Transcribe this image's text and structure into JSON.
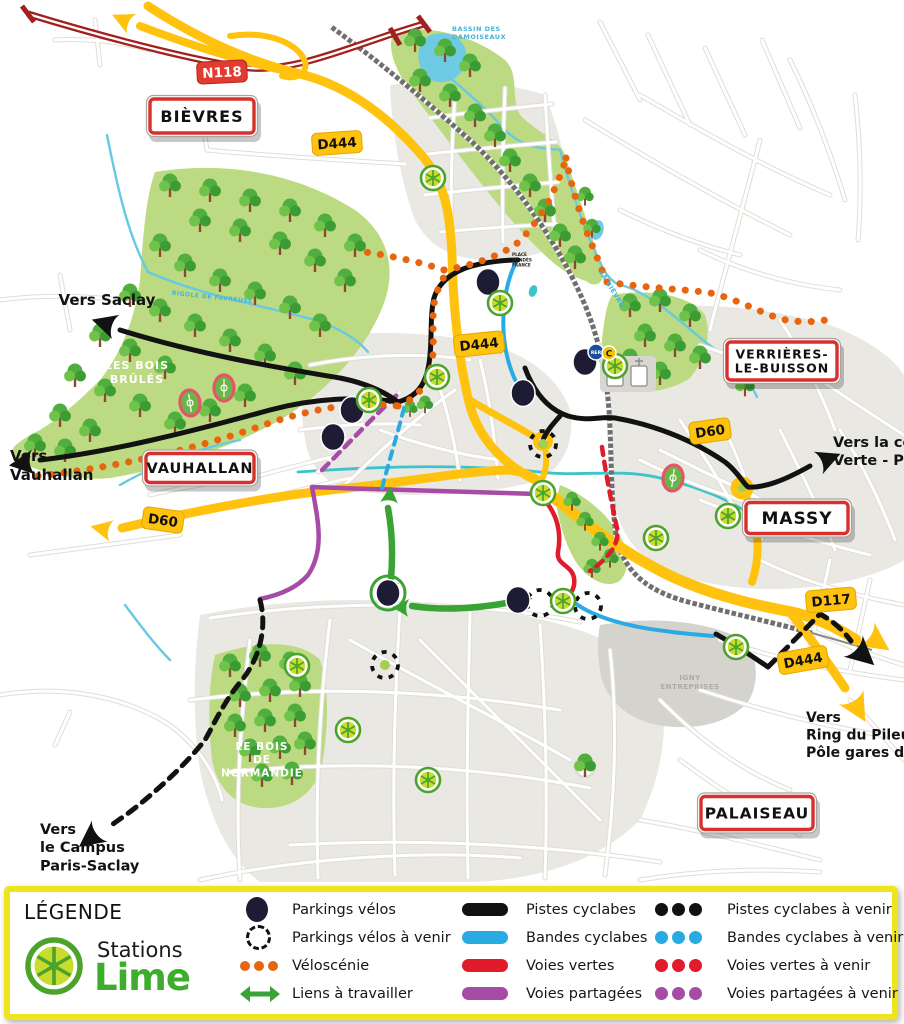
{
  "legend": {
    "title": "LÉGENDE",
    "brand": {
      "line1": "Stations",
      "line2": "Lime"
    },
    "points": [
      {
        "label": "Parkings vélos",
        "icon": "parking-dot"
      },
      {
        "label": "Parkings vélos à venir",
        "icon": "parking-dashed-circle"
      },
      {
        "label": "Véloscénie",
        "icon": "orange-dots"
      },
      {
        "label": "Liens à travailler",
        "icon": "green-double-arrow"
      }
    ],
    "lines": [
      {
        "label": "Pistes cyclabes",
        "color": "#111111"
      },
      {
        "label": "Bandes cyclabes",
        "color": "#29ABE2"
      },
      {
        "label": "Voies vertes",
        "color": "#E01B2C"
      },
      {
        "label": "Voies partagées",
        "color": "#A64CA6"
      }
    ],
    "future": [
      {
        "label": "Pistes cyclabes à venir",
        "color": "#111111"
      },
      {
        "label": "Bandes cyclabes à venir",
        "color": "#29ABE2"
      },
      {
        "label": "Voies vertes à venir",
        "color": "#E01B2C"
      },
      {
        "label": "Voies partagées à venir",
        "color": "#A64CA6"
      }
    ]
  },
  "map": {
    "town_signs": [
      {
        "lines": [
          "BIÈVRES"
        ],
        "x": 202,
        "y": 116,
        "w": 104,
        "h": 34,
        "fs": 16
      },
      {
        "lines": [
          "VAUHALLAN"
        ],
        "x": 200,
        "y": 468,
        "w": 108,
        "h": 29,
        "fs": 14.5
      },
      {
        "lines": [
          "VERRIÈRES-",
          "LE-BUISSON"
        ],
        "x": 782,
        "y": 361,
        "w": 110,
        "h": 38,
        "fs": 12.5
      },
      {
        "lines": [
          "MASSY"
        ],
        "x": 797,
        "y": 518,
        "w": 102,
        "h": 31,
        "fs": 17
      },
      {
        "lines": [
          "PALAISEAU"
        ],
        "x": 757,
        "y": 813,
        "w": 112,
        "h": 33,
        "fs": 15.5
      }
    ],
    "road_signs": [
      {
        "label": "N118",
        "kind": "n",
        "x": 222,
        "y": 72,
        "rot": -3
      },
      {
        "label": "D444",
        "kind": "d",
        "x": 337,
        "y": 143,
        "rot": -4
      },
      {
        "label": "D444",
        "kind": "d",
        "x": 479,
        "y": 344,
        "rot": -6
      },
      {
        "label": "D60",
        "kind": "d",
        "x": 710,
        "y": 431,
        "rot": -8
      },
      {
        "label": "D60",
        "kind": "d",
        "x": 163,
        "y": 520,
        "rot": 8
      },
      {
        "label": "D117",
        "kind": "d",
        "x": 831,
        "y": 600,
        "rot": -5
      },
      {
        "label": "D444",
        "kind": "d",
        "x": 803,
        "y": 660,
        "rot": -10
      }
    ],
    "labels": [
      {
        "lines": [
          "Vers Saclay"
        ],
        "x": 107,
        "y": 305,
        "cls": "t-dir",
        "size": 15,
        "anchor": "middle"
      },
      {
        "lines": [
          "Vers",
          "Vauhallan"
        ],
        "x": 10,
        "y": 461,
        "cls": "t-dir",
        "size": 15,
        "anchor": "start"
      },
      {
        "lines": [
          "Vers la coulée",
          "Verte - Paris"
        ],
        "x": 833,
        "y": 447,
        "cls": "t-dir",
        "size": 14.5,
        "anchor": "start"
      },
      {
        "lines": [
          "Vers",
          "Ring du Pileu",
          "Pôle gares de Massy"
        ],
        "x": 806,
        "y": 722,
        "cls": "t-dir",
        "size": 14,
        "anchor": "start"
      },
      {
        "lines": [
          "Vers",
          "le Campus",
          "Paris-Saclay"
        ],
        "x": 40,
        "y": 834,
        "cls": "t-dir",
        "size": 14.5,
        "anchor": "start"
      },
      {
        "lines": [
          "LES BOIS",
          "BRÛLÉS"
        ],
        "x": 137,
        "y": 369,
        "cls": "t-forest",
        "size": 11,
        "anchor": "middle"
      },
      {
        "lines": [
          "LE BOIS",
          "DE",
          "NORMANDIE"
        ],
        "x": 262,
        "y": 750,
        "cls": "t-forest",
        "size": 10.5,
        "anchor": "middle"
      },
      {
        "lines": [
          "BASSIN DES",
          "DAMOISEAUX"
        ],
        "x": 452,
        "y": 31,
        "cls": "t-water",
        "size": 6.5,
        "anchor": "start"
      },
      {
        "lines": [
          "LA BIÈVRE"
        ],
        "x": 610,
        "y": 290,
        "cls": "t-water",
        "size": 6.5,
        "anchor": "middle",
        "rotate": 58
      },
      {
        "lines": [
          "RIGOLE DE FAVREUSE"
        ],
        "x": 212,
        "y": 299,
        "cls": "t-water",
        "size": 6,
        "anchor": "middle",
        "rotate": 6
      },
      {
        "lines": [
          "IGNY",
          "ENTREPRISES"
        ],
        "x": 690,
        "y": 680,
        "cls": "t-gray",
        "size": 7,
        "anchor": "middle"
      },
      {
        "lines": [
          "PLACE",
          "MENDÈS",
          "FRANCE"
        ],
        "x": 512,
        "y": 256,
        "cls": "t-micro",
        "size": 4.2,
        "anchor": "start"
      }
    ],
    "rer_badge": {
      "x": 596,
      "y": 352,
      "rer": "RER",
      "c": "C"
    },
    "stations": [
      [
        433,
        178
      ],
      [
        500,
        303
      ],
      [
        437,
        377
      ],
      [
        615,
        366
      ],
      [
        369,
        400
      ],
      [
        543,
        493
      ],
      [
        656,
        538
      ],
      [
        728,
        516
      ],
      [
        563,
        601
      ],
      [
        736,
        647
      ],
      [
        297,
        666
      ],
      [
        348,
        730
      ],
      [
        428,
        780
      ]
    ],
    "parkings": [
      {
        "x": 488,
        "y": 282
      },
      {
        "x": 585,
        "y": 362
      },
      {
        "x": 523,
        "y": 393
      },
      {
        "x": 352,
        "y": 410
      },
      {
        "x": 333,
        "y": 437
      },
      {
        "x": 388,
        "y": 593,
        "ring": true
      },
      {
        "x": 518,
        "y": 600
      }
    ],
    "parkings_future": [
      {
        "x": 543,
        "y": 444,
        "green": true
      },
      {
        "x": 385,
        "y": 665,
        "green": true
      },
      {
        "x": 540,
        "y": 603
      },
      {
        "x": 588,
        "y": 606
      }
    ],
    "stadiums": [
      [
        190,
        403
      ],
      [
        224,
        388
      ],
      [
        673,
        478
      ]
    ],
    "colors": {
      "road_yellow": "#FFC20E",
      "road_national_red": "#A32020",
      "piste": "#111111",
      "bande": "#29ABE2",
      "voie_verte": "#E01B2C",
      "voie_partagee": "#A64CA6",
      "veloscenie": "#E8650D",
      "lien": "#3AA336",
      "parking": "#1E1C34",
      "forest": "#BCDA82",
      "urban": "#EAE8E3",
      "water": "#6FCBE4",
      "legend_border": "#EFE51D",
      "lime_green": "#3DAE2B"
    }
  }
}
